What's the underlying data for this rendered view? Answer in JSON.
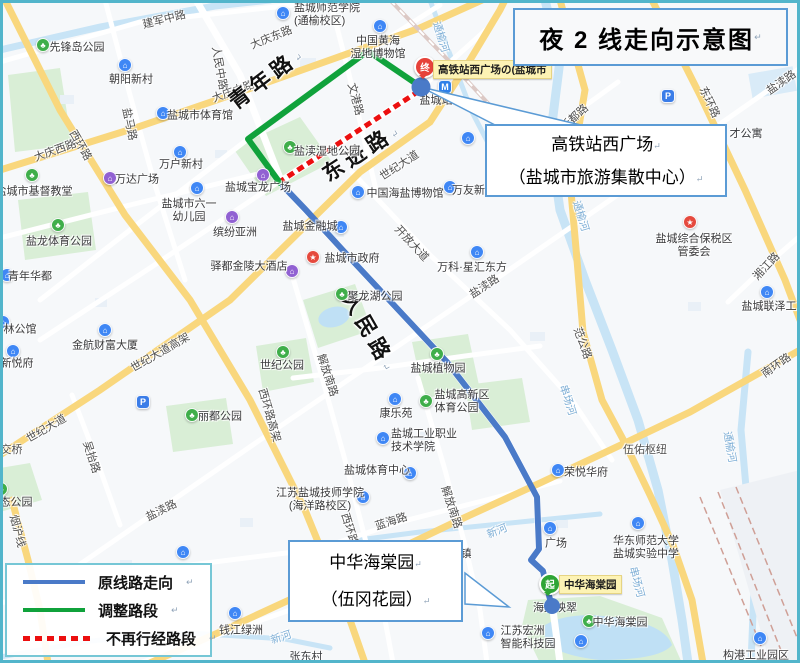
{
  "title": {
    "text": "夜 2 线走向示意图"
  },
  "marks": {
    "newline": "↵"
  },
  "callout_station": {
    "line1": "高铁站西广场",
    "line2": "（盐城市旅游集散中心）"
  },
  "callout_garden": {
    "line1": "中华海棠园",
    "line2": "（伍冈花园）"
  },
  "legend": {
    "items": [
      {
        "label": "原线路走向",
        "style": "solid",
        "color": "#4a7ac8"
      },
      {
        "label": "调整路段",
        "style": "solid",
        "color": "#10a23b"
      },
      {
        "label": "不再行经路段",
        "style": "dashed",
        "color": "#ec0f0f"
      }
    ]
  },
  "stops": {
    "terminal": {
      "badge": "终",
      "label": "高铁站西广场の(盐城市",
      "color": "#e6423a"
    },
    "start": {
      "badge": "起",
      "label": "中华海棠园",
      "color": "#2fa535"
    }
  },
  "palette": {
    "route_blue": "#4a7ac8",
    "route_green": "#10a23b",
    "route_red": "#ec0f0f",
    "frame": "#52b5cb",
    "panel_border": "#5b9bd5",
    "legend_border": "#76c7d6",
    "road_yellow": "#f9d77d",
    "water": "#c8e4f6",
    "park": "#d9eed6"
  },
  "icon_glyphs": {
    "park": "♣",
    "building": "⌂",
    "mall": "⌂",
    "gov": "★",
    "parking": "P",
    "metro": "M"
  },
  "icon_colors": {
    "park": "#3fae4a",
    "building": "#3f87f5",
    "mall": "#9161d2",
    "gov": "#e5493d",
    "parking": "#3b7de8",
    "metro": "#2e7fe8"
  },
  "map_labels": [
    {
      "t": "建军中路",
      "x": 164,
      "y": 19,
      "r": -14
    },
    {
      "t": "人民中路",
      "x": 220,
      "y": 68,
      "r": 80
    },
    {
      "t": "大庆中路",
      "x": 233,
      "y": 91,
      "r": -20
    },
    {
      "t": "大庆东路",
      "x": 271,
      "y": 37,
      "r": -22
    },
    {
      "t": "大庆西路",
      "x": 55,
      "y": 150,
      "r": -20
    },
    {
      "t": "西环路",
      "x": 81,
      "y": 145,
      "r": 60
    },
    {
      "t": "盐马路",
      "x": 130,
      "y": 124,
      "r": 78
    },
    {
      "t": "文港路",
      "x": 356,
      "y": 99,
      "r": 75
    },
    {
      "t": "青年路",
      "x": 265,
      "y": 78,
      "r": -37,
      "c": "road-big",
      "m": true
    },
    {
      "t": "东进路",
      "x": 360,
      "y": 152,
      "r": -33,
      "c": "road-big",
      "m": true
    },
    {
      "t": "人民路",
      "x": 370,
      "y": 331,
      "r": 60,
      "c": "road-big",
      "m": true
    },
    {
      "t": "世纪大道",
      "x": 399,
      "y": 165,
      "r": -33
    },
    {
      "t": "开放大道",
      "x": 412,
      "y": 243,
      "r": 47
    },
    {
      "t": "盐渎路",
      "x": 484,
      "y": 286,
      "r": -33
    },
    {
      "t": "新都路",
      "x": 574,
      "y": 117,
      "r": -42
    },
    {
      "t": "东环路",
      "x": 710,
      "y": 102,
      "r": 65
    },
    {
      "t": "盐渎路",
      "x": 781,
      "y": 82,
      "r": -35
    },
    {
      "t": "才公寓",
      "x": 746,
      "y": 133,
      "r": 0,
      "c": "poi-sub"
    },
    {
      "t": "通榆河",
      "x": 441,
      "y": 37,
      "r": 73,
      "c": "river"
    },
    {
      "t": "通榆河",
      "x": 581,
      "y": 216,
      "r": 73,
      "c": "river"
    },
    {
      "t": "通榆河",
      "x": 730,
      "y": 447,
      "r": 80,
      "c": "river"
    },
    {
      "t": "串场河",
      "x": 568,
      "y": 400,
      "r": 72,
      "c": "river"
    },
    {
      "t": "串场河",
      "x": 637,
      "y": 582,
      "r": 75,
      "c": "river"
    },
    {
      "t": "新河",
      "x": 497,
      "y": 531,
      "r": -22,
      "c": "river"
    },
    {
      "t": "新河",
      "x": 281,
      "y": 637,
      "r": -18,
      "c": "river"
    },
    {
      "t": "范公路",
      "x": 583,
      "y": 343,
      "r": 70
    },
    {
      "t": "湘江路",
      "x": 766,
      "y": 266,
      "r": -47
    },
    {
      "t": "世纪大道高架",
      "x": 160,
      "y": 352,
      "r": -30
    },
    {
      "t": "世纪大道",
      "x": 46,
      "y": 428,
      "r": -30
    },
    {
      "t": "吴抬路",
      "x": 92,
      "y": 457,
      "r": 72
    },
    {
      "t": "西环路高架",
      "x": 270,
      "y": 415,
      "r": 74
    },
    {
      "t": "解放南路",
      "x": 328,
      "y": 375,
      "r": 72
    },
    {
      "t": "解放南路",
      "x": 452,
      "y": 507,
      "r": 72
    },
    {
      "t": "蓝海路",
      "x": 391,
      "y": 521,
      "r": -18
    },
    {
      "t": "西环路",
      "x": 350,
      "y": 529,
      "r": 73
    },
    {
      "t": "南环路",
      "x": 776,
      "y": 365,
      "r": -35
    },
    {
      "t": "烟沪线",
      "x": 18,
      "y": 531,
      "r": 75
    },
    {
      "t": "盐渎路",
      "x": 161,
      "y": 510,
      "r": -27
    },
    {
      "t": "伍佑枢纽",
      "x": 645,
      "y": 449,
      "r": 0
    },
    {
      "t": "立交桥",
      "x": 6,
      "y": 449,
      "r": 0
    },
    {
      "t": "张东村",
      "x": 306,
      "y": 656,
      "r": 0,
      "c": "poi-sub"
    },
    {
      "t": "镇",
      "x": 466,
      "y": 553,
      "r": 0,
      "c": "poi-sub"
    },
    {
      "t": "海棠映翠",
      "x": 555,
      "y": 607,
      "r": 0,
      "c": "poi-sub"
    }
  ],
  "pois": [
    {
      "t": "先锋岛公园",
      "icon": "park",
      "ix": 43,
      "iy": 45,
      "lx": 77,
      "ly": 48,
      "ta": "l"
    },
    {
      "t": "盐城市基督教堂",
      "icon": "park",
      "ix": 32,
      "iy": 175,
      "lx": 34,
      "ly": 192,
      "ta": "c"
    },
    {
      "t": "盐龙体育公园",
      "icon": "park",
      "ix": 58,
      "iy": 225,
      "lx": 59,
      "ly": 242,
      "ta": "c"
    },
    {
      "t": "盐渎湿地公园",
      "icon": "park",
      "ix": 290,
      "iy": 147,
      "lx": 327,
      "ly": 152,
      "ta": "l"
    },
    {
      "t": "聚龙湖公园",
      "icon": "park",
      "ix": 342,
      "iy": 294,
      "lx": 375,
      "ly": 297,
      "ta": "l"
    },
    {
      "t": "世纪公园",
      "icon": "park",
      "ix": 283,
      "iy": 352,
      "lx": 282,
      "ly": 366,
      "ta": "c"
    },
    {
      "t": "盐城植物园",
      "icon": "park",
      "ix": 437,
      "iy": 354,
      "lx": 438,
      "ly": 369,
      "ta": "c"
    },
    {
      "t": "丽都公园",
      "icon": "park",
      "ix": 192,
      "iy": 415,
      "lx": 220,
      "ly": 417,
      "ta": "l"
    },
    {
      "t": [
        "盐城高新区",
        "体育公园"
      ],
      "icon": "park",
      "ix": 426,
      "iy": 401,
      "lx": 462,
      "ly": 402,
      "ta": "l"
    },
    {
      "t": "中华海棠园",
      "icon": "park",
      "ix": 589,
      "iy": 621,
      "lx": 620,
      "ly": 623,
      "ta": "l"
    },
    {
      "t": "态公园",
      "icon": "park",
      "ix": 1,
      "iy": 489,
      "lx": 16,
      "ly": 503,
      "ta": "l"
    },
    {
      "t": "朝阳新村",
      "icon": "building",
      "ix": 125,
      "iy": 65,
      "lx": 131,
      "ly": 80,
      "ta": "c"
    },
    {
      "t": "盐城市体育馆",
      "icon": "building",
      "ix": 163,
      "iy": 113,
      "lx": 200,
      "ly": 116,
      "ta": "l"
    },
    {
      "t": "万户新村",
      "icon": "building",
      "ix": 180,
      "iy": 152,
      "lx": 181,
      "ly": 165,
      "ta": "c"
    },
    {
      "t": "青年华都",
      "icon": "building",
      "ix": 7,
      "iy": 275,
      "lx": 30,
      "ly": 277,
      "ta": "l"
    },
    {
      "t": "林公馆",
      "icon": "building",
      "ix": 3,
      "iy": 322,
      "lx": 20,
      "ly": 330,
      "ta": "l"
    },
    {
      "t": "金航财富大厦",
      "icon": "building",
      "ix": 105,
      "iy": 330,
      "lx": 105,
      "ly": 346,
      "ta": "c"
    },
    {
      "t": "新悦府",
      "icon": "building",
      "ix": 13,
      "iy": 351,
      "lx": 17,
      "ly": 364,
      "ta": "c"
    },
    {
      "t": [
        "盐城市六一",
        "幼儿园"
      ],
      "icon": "building",
      "ix": 197,
      "iy": 188,
      "lx": 189,
      "ly": 211,
      "ta": "c"
    },
    {
      "t": "盐城金融城",
      "icon": "building",
      "ix": 341,
      "iy": 227,
      "lx": 310,
      "ly": 227,
      "ta": "r"
    },
    {
      "t": "中国海盐博物馆",
      "icon": "building",
      "ix": 358,
      "iy": 192,
      "lx": 405,
      "ly": 194,
      "ta": "l"
    },
    {
      "t": "万友新村",
      "icon": "building",
      "ix": 450,
      "iy": 187,
      "lx": 474,
      "ly": 191,
      "ta": "l"
    },
    {
      "t": "万科·星汇东方",
      "icon": "building",
      "ix": 477,
      "iy": 252,
      "lx": 472,
      "ly": 268,
      "ta": "c"
    },
    {
      "t": "康乐苑",
      "icon": "building",
      "ix": 395,
      "iy": 399,
      "lx": 396,
      "ly": 414,
      "ta": "c"
    },
    {
      "t": [
        "盐城工业职业",
        "技术学院"
      ],
      "icon": "building",
      "ix": 383,
      "iy": 438,
      "lx": 424,
      "ly": 441,
      "ta": "l"
    },
    {
      "t": "盐城体育中心",
      "icon": "building",
      "ix": 410,
      "iy": 473,
      "lx": 377,
      "ly": 471,
      "ta": "r"
    },
    {
      "t": [
        "江苏盐城技师学院",
        "(海洋路校区)"
      ],
      "icon": "building",
      "ix": 363,
      "iy": 497,
      "lx": 320,
      "ly": 500,
      "ta": "c"
    },
    {
      "t": "荣悦华府",
      "icon": "building",
      "ix": 558,
      "iy": 470,
      "lx": 586,
      "ly": 473,
      "ta": "l"
    },
    {
      "t": [
        "华东师范大学",
        "盐城实验中学"
      ],
      "icon": "building",
      "ix": 638,
      "iy": 523,
      "lx": 646,
      "ly": 548,
      "ta": "c"
    },
    {
      "t": "钱江绿洲",
      "icon": "building",
      "ix": 235,
      "iy": 613,
      "lx": 241,
      "ly": 631,
      "ta": "c"
    },
    {
      "t": [
        "江苏宏洲",
        "智能科技园"
      ],
      "icon": "building",
      "ix": 488,
      "iy": 633,
      "lx": 528,
      "ly": 638,
      "ta": "l"
    },
    {
      "t": "构港工业园区",
      "icon": "building",
      "ix": 760,
      "iy": 638,
      "lx": 756,
      "ly": 656,
      "ta": "c"
    },
    {
      "t": "盐城联泽工业园",
      "icon": "building",
      "ix": 767,
      "iy": 292,
      "lx": 780,
      "ly": 307,
      "ta": "c"
    },
    {
      "t": [
        "盐城师范学院",
        "(通榆校区)"
      ],
      "icon": "building",
      "ix": 283,
      "iy": 13,
      "lx": 327,
      "ly": 15,
      "ta": "l"
    },
    {
      "t": [
        "中国黄海",
        "湿地博物馆"
      ],
      "icon": "building",
      "ix": 380,
      "iy": 26,
      "lx": 378,
      "ly": 48,
      "ta": "c"
    },
    {
      "t": null,
      "icon": "building",
      "ix": 468,
      "iy": 138
    },
    {
      "t": null,
      "icon": "building",
      "ix": 183,
      "iy": 552
    },
    {
      "t": null,
      "icon": "building",
      "ix": 581,
      "iy": 641
    },
    {
      "t": "万达广场",
      "icon": "mall",
      "ix": 110,
      "iy": 178,
      "lx": 137,
      "ly": 180,
      "ta": "l"
    },
    {
      "t": "缤纷亚洲",
      "icon": "mall",
      "ix": 232,
      "iy": 217,
      "lx": 235,
      "ly": 233,
      "ta": "c"
    },
    {
      "t": "盐城宝龙广场",
      "icon": "mall",
      "ix": 263,
      "iy": 175,
      "lx": 258,
      "ly": 188,
      "ta": "c"
    },
    {
      "t": "驿都金陵大酒店",
      "icon": "mall",
      "ix": 292,
      "iy": 271,
      "lx": 249,
      "ly": 267,
      "ta": "r"
    },
    {
      "t": "盐城市政府",
      "icon": "gov",
      "ix": 313,
      "iy": 257,
      "lx": 352,
      "ly": 259,
      "ta": "l"
    },
    {
      "t": [
        "盐城综合保税区",
        "管委会"
      ],
      "icon": "gov",
      "ix": 690,
      "iy": 222,
      "lx": 694,
      "ly": 246,
      "ta": "c"
    },
    {
      "t": null,
      "icon": "parking",
      "ix": 668,
      "iy": 96
    },
    {
      "t": null,
      "icon": "parking",
      "ix": 143,
      "iy": 402
    },
    {
      "t": "盐城站",
      "icon": "metro",
      "ix": 445,
      "iy": 87,
      "lx": 436,
      "ly": 101,
      "ta": "c"
    },
    {
      "t": "广场",
      "icon": "building",
      "ix": 550,
      "iy": 528,
      "lx": 556,
      "ly": 544,
      "ta": "c"
    }
  ]
}
